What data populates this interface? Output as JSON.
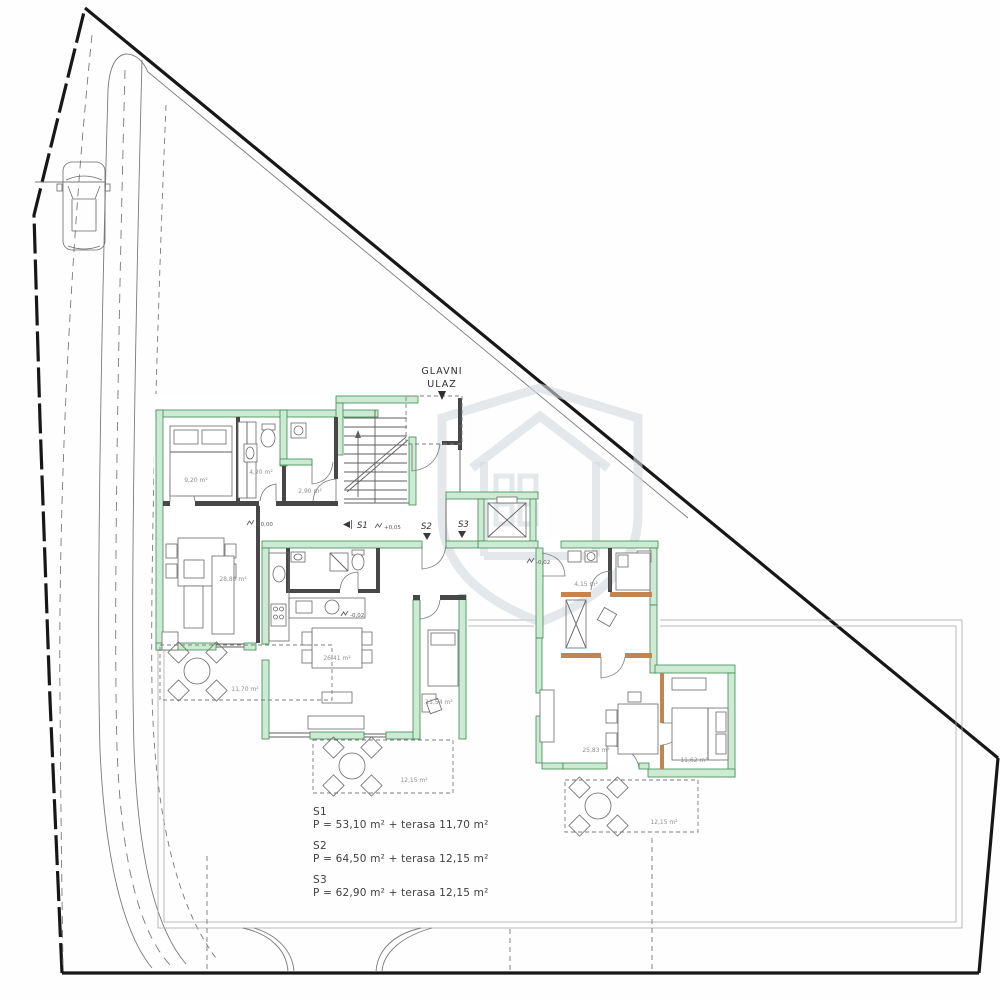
{
  "entrance": {
    "line1": "GLAVNI",
    "line2": "ULAZ"
  },
  "markers": {
    "s1": "S1",
    "s2": "S2",
    "s3": "S3"
  },
  "elevations": {
    "hall": "±0,00",
    "stairs": "+0,05",
    "s2": "-0,02",
    "s3": "-0,02"
  },
  "areas": {
    "s1_bedroom": "9,20 m²",
    "s1_bath": "4,20 m²",
    "s1_hall": "2,90 m²",
    "s1_living": "28,80 m²",
    "s1_terrace": "11,70 m²",
    "s2_living": "26,41 m²",
    "s2_bedroom": "11,54 m²",
    "s2_terrace": "12,15 m²",
    "s3_bath": "4,15 m²",
    "s3_living": "25,83 m²",
    "s3_bedroom": "11,62 m²",
    "s3_terrace": "12,15 m²"
  },
  "legend": {
    "items": [
      {
        "id": "S1",
        "area": "P = 53,10 m² + terasa 11,70 m²"
      },
      {
        "id": "S2",
        "area": "P = 64,50 m² + terasa 12,15 m²"
      },
      {
        "id": "S3",
        "area": "P = 62,90 m² + terasa 12,15 m²"
      }
    ]
  },
  "colors": {
    "wall_fill": "#cdebd2",
    "wall_stroke": "#3c8a54",
    "accent_wood": "#c08552",
    "boundary": "#171717",
    "watermark": "#d2d8dc"
  }
}
